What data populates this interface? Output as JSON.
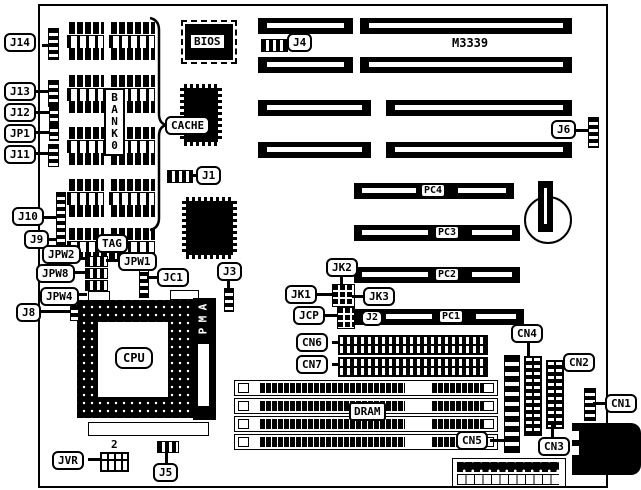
{
  "diagram": {
    "model": "M3339",
    "chips": {
      "bios": "BIOS",
      "cache": "CACHE",
      "cpu": "CPU",
      "dram": "DRAM",
      "tag": "TAG"
    },
    "vertical": {
      "bank": "BANK0",
      "socket": "AMP"
    },
    "slots": {
      "pc1": "PC1",
      "pc2": "PC2",
      "pc3": "PC3",
      "pc4": "PC4"
    },
    "jumpers": {
      "j1": "J1",
      "j2": "J2",
      "j3": "J3",
      "j4": "J4",
      "j5": "J5",
      "j6": "J6",
      "j8": "J8",
      "j9": "J9",
      "j10": "J10",
      "j11": "J11",
      "j12": "J12",
      "j13": "J13",
      "j14": "J14",
      "jp1": "JP1",
      "jpw1": "JPW1",
      "jpw2": "JPW2",
      "jpw8": "JPW8",
      "jpw4": "JPW4",
      "jc1": "JC1",
      "jk1": "JK1",
      "jk2": "JK2",
      "jk3": "JK3",
      "jcp": "JCP",
      "jvr": "JVR"
    },
    "connectors": {
      "cn1": "CN1",
      "cn2": "CN2",
      "cn3": "CN3",
      "cn4": "CN4",
      "cn5": "CN5",
      "cn6": "CN6",
      "cn7": "CN7"
    },
    "notes": {
      "jvr_pin_number": "2"
    }
  }
}
